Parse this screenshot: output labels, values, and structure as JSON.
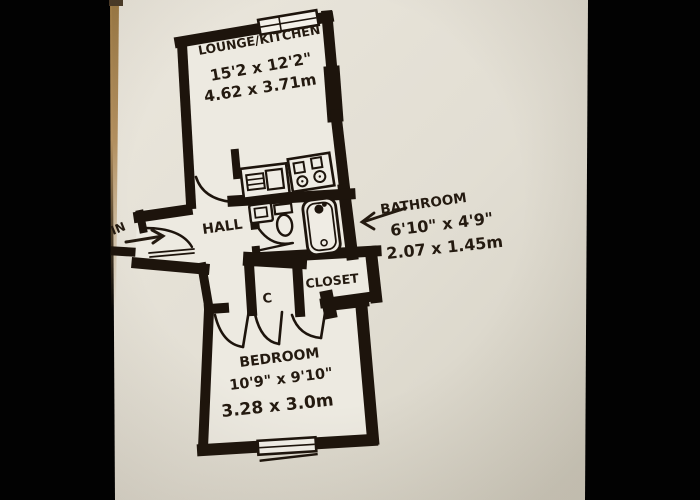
{
  "photo": {
    "description": "Hand-drawn floor plan of a one-bedroom flat, black marker on cream paper, photographed with black bars left and right",
    "colors": {
      "backdrop": "#000000",
      "paper": "#e6e2d7",
      "ink": "#1d140c",
      "wood_edge": "#a8834f"
    }
  },
  "floorplan": {
    "entrance": {
      "label": "IN"
    },
    "rooms": [
      {
        "id": "lounge",
        "name": "LOUNGE/KITCHEN",
        "dims_imperial": "15'2 x 12'2\"",
        "dims_metric": "4.62 x 3.71m"
      },
      {
        "id": "hall",
        "name": "HALL"
      },
      {
        "id": "bathroom",
        "name": "BATHROOM",
        "dims_imperial": "6'10\" x 4'9\"",
        "dims_metric": "2.07 x 1.45m"
      },
      {
        "id": "cupboard",
        "name": "C"
      },
      {
        "id": "closet",
        "name": "CLOSET"
      },
      {
        "id": "bedroom",
        "name": "BEDROOM",
        "dims_imperial": "10'9\" x 9'10\"",
        "dims_metric": "3.28 x 3.0m"
      }
    ],
    "fixtures": [
      "kitchen-sink-unit",
      "hob",
      "bathroom-sink",
      "toilet",
      "bathtub"
    ],
    "windows": [
      "lounge-window",
      "bedroom-window"
    ],
    "doors": [
      "front-door",
      "lounge-door",
      "bathroom-door",
      "bedroom-door",
      "cupboard-door",
      "closet-door"
    ]
  }
}
